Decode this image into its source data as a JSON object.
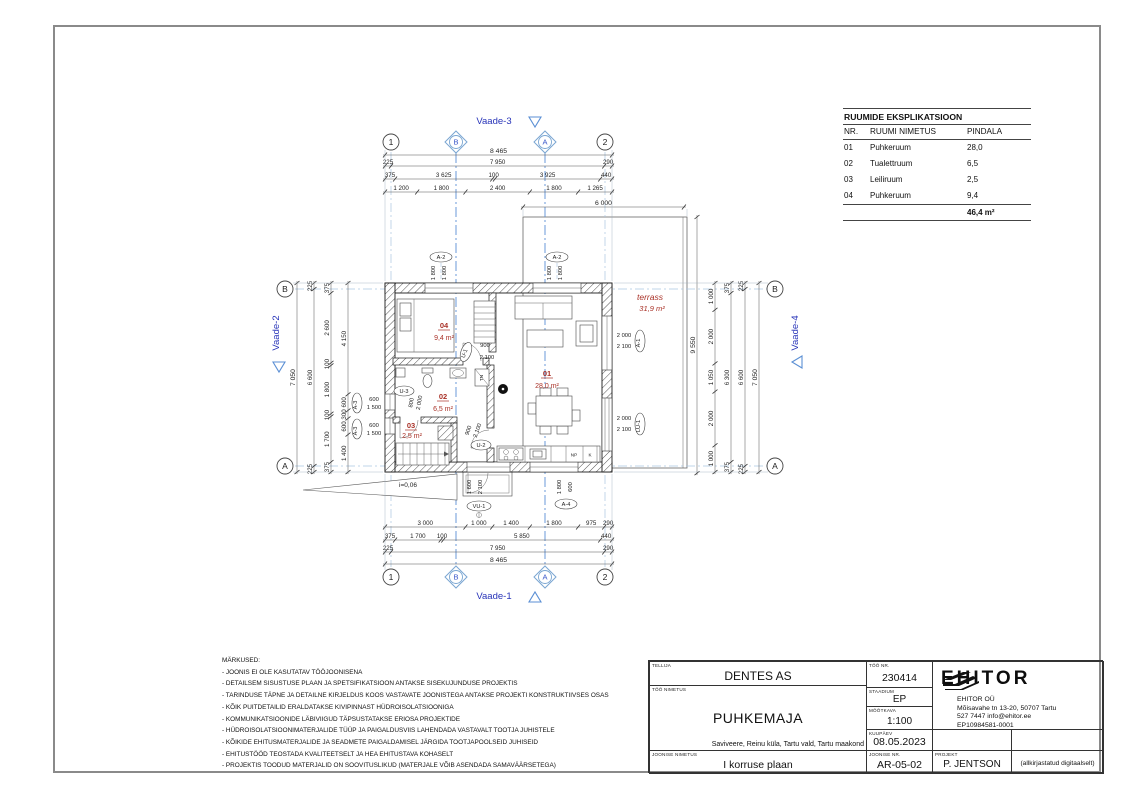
{
  "sheet": {
    "explication": {
      "title": "RUUMIDE EKSPLIKATSIOON",
      "col_nr": "NR.",
      "col_name": "RUUMI NIMETUS",
      "col_area": "PINDALA",
      "rows": [
        {
          "nr": "01",
          "name": "Puhkeruum",
          "area": "28,0"
        },
        {
          "nr": "02",
          "name": "Tualettruum",
          "area": "6,5"
        },
        {
          "nr": "03",
          "name": "Leiliruum",
          "area": "2,5"
        },
        {
          "nr": "04",
          "name": "Puhkeruum",
          "area": "9,4"
        }
      ],
      "total": "46,4 m²"
    },
    "notes": {
      "heading": "MÄRKUSED:",
      "items": [
        "- JOONIS EI OLE KASUTATAV TÖÖJOONISENA",
        "- DETAILSEM SISUSTUSE PLAAN JA SPETSIFIKATSIOON ANTAKSE SISEKUJUNDUSE PROJEKTIS",
        "- TARINDUSE TÄPNE JA DETAILNE KIRJELDUS KOOS VASTAVATE JOONISTEGA ANTAKSE PROJEKTI KONSTRUKTIIVSES OSAS",
        "- KÕIK PUITDETAILID ERALDATAKSE KIVIPINNAST HÜDROISOLATSIOONIGA",
        "- KOMMUNIKATSIOONIDE LÄBIVIIGUD TÄPSUSTATAKSE ERIOSA PROJEKTIDE",
        "- HÜDROISOLATSIOONIMATERJALIDE TÜÜP JA PAIGALDUSVIIS LAHENDADA VASTAVALT TOOTJA JUHISTELE",
        "- KÕIKIDE EHITUSMATERJALIDE JA SEADMETE PAIGALDAMISEL JÄRGIDA TOOTJAPOOLSEID JUHISEID",
        "- EHITUSTÖÖD TEOSTADA KVALITEETSELT JA HEA EHITUSTAVA KOHASELT",
        "- PROJEKTIS TOODUD MATERJALID ON SOOVITUSLIKUD (MATERJALE VÕIB ASENDADA SAMAVÄÄRSETEGA)"
      ]
    },
    "titleblock": {
      "tellija_label": "TELLIJA",
      "tellija": "DENTES AS",
      "too_nr_label": "TÖÖ NR.",
      "too_nr": "230414",
      "too_nimetus_label": "TÖÖ NIMETUS",
      "too_nimetus": "PUHKEMAJA",
      "staadium_label": "STAADIUM",
      "staadium": "EP",
      "mootkava_label": "MÕÕTKAVA",
      "mootkava": "1:100",
      "aadress": "Saviveere, Reinu küla, Tartu vald, Tartu maakond",
      "kuupaev_label": "KUUPÄEV",
      "kuupaev": "08.05.2023",
      "joonise_nimetus_label": "JOONISE NIMETUS",
      "joonise_nimetus": "I korruse plaan",
      "joonise_nr_label": "JOONISE NR.",
      "joonise_nr": "AR-05-02",
      "projekt_label": "PROJEKT",
      "projekt": "P. JENTSON",
      "signature": "(allkirjastatud digitaalselt)",
      "firm": {
        "name": "EHITOR",
        "legal": "EHITOR OÜ",
        "address": "Mõisavahe tn 13-20, 50707 Tartu",
        "phone_email": "527 7447   info@ehitor.ee",
        "reg": "EP10984581-0001"
      }
    }
  },
  "plan": {
    "chains": {
      "t1": [
        "8 465"
      ],
      "t2": [
        "225",
        "7 950",
        "290"
      ],
      "t3": [
        "375",
        "3 625",
        "100",
        "3 925",
        "440"
      ],
      "t4": [
        "1 200",
        "1 800",
        "2 400",
        "1 800",
        "1 265"
      ],
      "tt": [
        "6 000"
      ],
      "b1": [
        "3 000",
        "1 000",
        "1 400",
        "1 800",
        "975",
        "290"
      ],
      "b2": [
        "375",
        "1 700",
        "100",
        "5 850",
        "440"
      ],
      "b3": [
        "225",
        "7 950",
        "290"
      ],
      "b4": [
        "8 465"
      ],
      "l1": [
        "7 050"
      ],
      "l2": [
        "225",
        "6 600",
        "225"
      ],
      "l3": [
        "375",
        "2 600",
        "100",
        "1 800",
        "100",
        "1 700",
        "375"
      ],
      "l4": [
        "4 150",
        "600",
        "300",
        "600",
        "1 400"
      ],
      "r1": [
        "1 000",
        "2 000",
        "1 050",
        "2 000",
        "1 000"
      ],
      "r2": [
        "375",
        "6 300",
        "375"
      ],
      "r3": [
        "225",
        "6 600",
        "225"
      ],
      "r4": [
        "7 050"
      ],
      "tr": [
        "9 550"
      ]
    },
    "grid": {
      "one": "1",
      "two": "2",
      "a": "A",
      "b": "B"
    },
    "views": {
      "v1": "Vaade-1",
      "v2": "Vaade-2",
      "v3": "Vaade-3",
      "v4": "Vaade-4"
    },
    "rooms": {
      "r01": {
        "nr": "01",
        "area": "28,0 m²"
      },
      "r02": {
        "nr": "02",
        "area": "6,5 m²"
      },
      "r03": {
        "nr": "03",
        "area": "2,5 m²"
      },
      "r04": {
        "nr": "04",
        "area": "9,4 m²"
      }
    },
    "terrace": {
      "name": "terrass",
      "area": "31,9 m²"
    },
    "tags": {
      "a2": {
        "label": "A-2",
        "w": "1 800",
        "h": "1 800"
      },
      "a1": {
        "label": "A-1",
        "w": "2 000",
        "h": "2 100"
      },
      "lu1": {
        "label": "LU-1",
        "w": "2 000",
        "h": "2 100"
      },
      "a3": {
        "label": "A-3",
        "w": "600",
        "h": "1 500"
      },
      "a4": {
        "label": "A-4",
        "w": "1 800",
        "h": "600"
      },
      "vu1": {
        "label": "VU-1",
        "w": "1 600",
        "h": "2 100"
      },
      "u1": {
        "label": "U-1",
        "w": "900",
        "h": "2 100"
      },
      "u2": {
        "label": "U-2",
        "w": "900",
        "h": "2 100"
      },
      "u3": {
        "label": "U-3",
        "w": "800",
        "h": "2 000"
      }
    },
    "misc": {
      "slope": "i=0,06",
      "np": "NP",
      "k": "K",
      "tn": "TN"
    }
  },
  "colors": {
    "accent_blue": "#2733b8",
    "marker_blue": "#7aa6d2",
    "room_red": "#a93127",
    "line_dark": "#1a1a1a"
  }
}
